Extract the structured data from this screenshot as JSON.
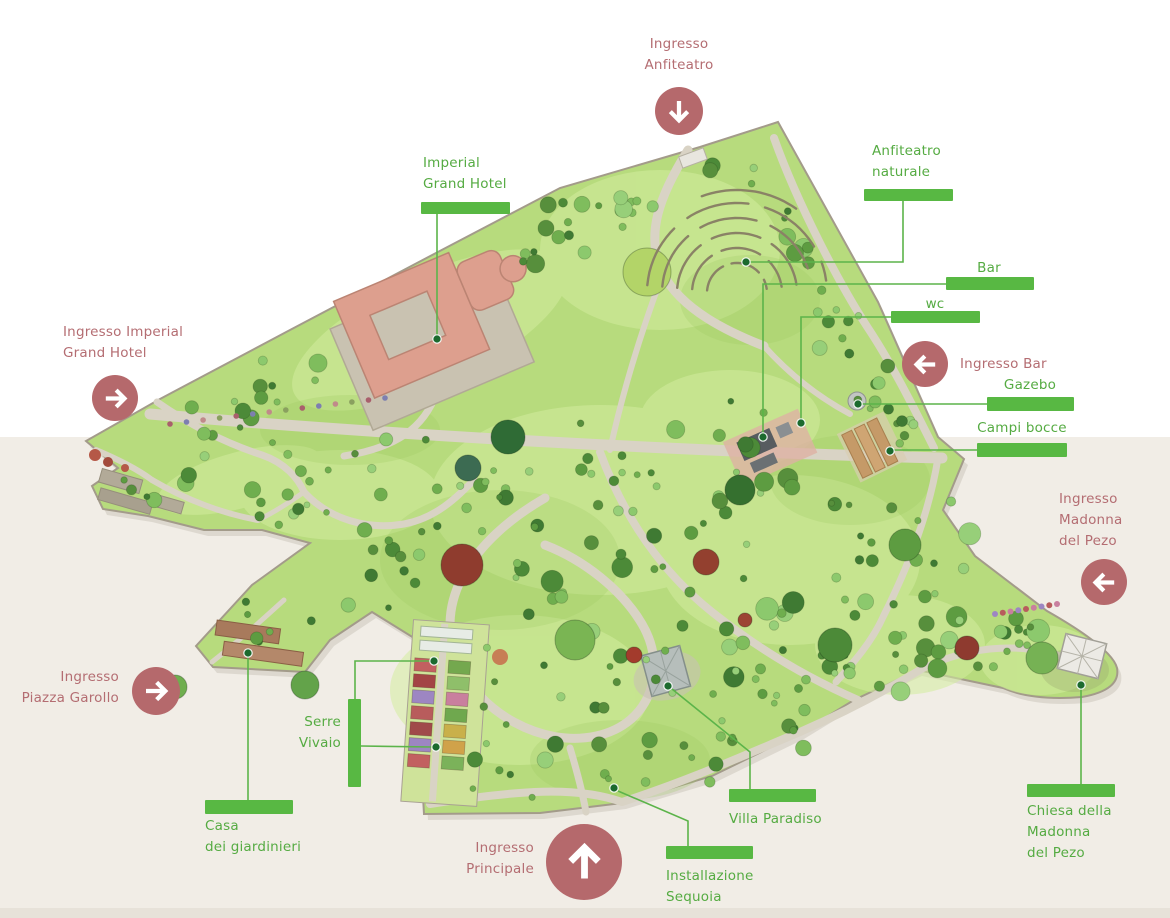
{
  "background": {
    "top_color": "#ffffff",
    "bottom_color": "#f1ede6",
    "bottom_strip_color": "#e7e2d9",
    "band_y": 437,
    "strip_y": 908
  },
  "palette": {
    "label_green": "#55ab42",
    "bar_green": "#58b843",
    "line_green": "#5cb44a",
    "dot_green": "#1c6a2e",
    "entrance_circle_red": "#b5696c",
    "entrance_text_red": "#b46d72",
    "arrow_white": "#ffffff",
    "lawn_green": "#b7db7d",
    "path_grey": "#d9d3c5",
    "hotel_roof_salmon": "#dd9f8e"
  },
  "poi_labels": [
    {
      "id": "imperial-grand-hotel",
      "lines": [
        "Imperial",
        "Grand Hotel"
      ],
      "text": {
        "left": 423,
        "top": 153,
        "width": 120,
        "align": "left"
      },
      "bar": {
        "x": 421,
        "y": 202,
        "w": 89,
        "h": 12
      },
      "connectors": [
        {
          "points": [
            [
              437,
              214
            ],
            [
              437,
              336
            ]
          ],
          "dot": [
            437,
            339
          ]
        }
      ]
    },
    {
      "id": "anfiteatro-naturale",
      "lines": [
        "Anfiteatro",
        "naturale"
      ],
      "text": {
        "left": 872,
        "top": 141,
        "width": 120,
        "align": "left"
      },
      "bar": {
        "x": 864,
        "y": 189,
        "w": 89,
        "h": 12
      },
      "connectors": [
        {
          "points": [
            [
              903,
              201
            ],
            [
              903,
              262
            ],
            [
              750,
              262
            ]
          ],
          "dot": [
            746,
            262
          ]
        }
      ]
    },
    {
      "id": "bar",
      "lines": [
        "Bar"
      ],
      "text": {
        "left": 939,
        "top": 258,
        "width": 100,
        "align": "center"
      },
      "bar": {
        "x": 946,
        "y": 277,
        "w": 88,
        "h": 13
      },
      "connectors": [
        {
          "points": [
            [
              946,
              284
            ],
            [
              763,
              284
            ],
            [
              763,
              433
            ]
          ],
          "dot": [
            763,
            437
          ]
        }
      ]
    },
    {
      "id": "wc",
      "lines": [
        "wc"
      ],
      "text": {
        "left": 885,
        "top": 294,
        "width": 100,
        "align": "center"
      },
      "bar": {
        "x": 891,
        "y": 311,
        "w": 89,
        "h": 12
      },
      "connectors": [
        {
          "points": [
            [
              891,
              317
            ],
            [
              801,
              317
            ],
            [
              801,
              419
            ]
          ],
          "dot": [
            801,
            423
          ]
        }
      ]
    },
    {
      "id": "gazebo",
      "lines": [
        "Gazebo"
      ],
      "text": {
        "left": 980,
        "top": 375,
        "width": 100,
        "align": "center"
      },
      "bar": {
        "x": 987,
        "y": 397,
        "w": 87,
        "h": 14
      },
      "connectors": [
        {
          "points": [
            [
              987,
              404
            ],
            [
              862,
              404
            ]
          ],
          "dot": [
            858,
            404
          ]
        }
      ]
    },
    {
      "id": "campi-bocce",
      "lines": [
        "Campi bocce"
      ],
      "text": {
        "left": 972,
        "top": 418,
        "width": 100,
        "align": "center"
      },
      "bar": {
        "x": 977,
        "y": 443,
        "w": 90,
        "h": 14
      },
      "connectors": [
        {
          "points": [
            [
              977,
              450
            ],
            [
              894,
              450
            ]
          ],
          "dot": [
            890,
            451
          ]
        }
      ]
    },
    {
      "id": "serre-vivaio",
      "lines": [
        "Serre",
        "Vivaio"
      ],
      "text": {
        "left": 241,
        "top": 712,
        "width": 100,
        "align": "right"
      },
      "bar": {
        "x": 348,
        "y": 699,
        "w": 13,
        "h": 88
      },
      "connectors": [
        {
          "points": [
            [
              355,
              699
            ],
            [
              355,
              661
            ],
            [
              430,
              661
            ]
          ],
          "dot": [
            434,
            661
          ]
        },
        {
          "points": [
            [
              361,
              746
            ],
            [
              432,
              747
            ]
          ],
          "dot": [
            436,
            747
          ]
        }
      ]
    },
    {
      "id": "casa-dei-giardinieri",
      "lines": [
        "Casa",
        "dei giardinieri"
      ],
      "text": {
        "left": 205,
        "top": 816,
        "width": 140,
        "align": "left"
      },
      "bar": {
        "x": 205,
        "y": 800,
        "w": 88,
        "h": 14
      },
      "connectors": [
        {
          "points": [
            [
              248,
              800
            ],
            [
              248,
              657
            ]
          ],
          "dot": [
            248,
            653
          ]
        }
      ]
    },
    {
      "id": "villa-paradiso",
      "lines": [
        "Villa Paradiso"
      ],
      "text": {
        "left": 729,
        "top": 809,
        "width": 120,
        "align": "left"
      },
      "bar": {
        "x": 729,
        "y": 789,
        "w": 87,
        "h": 13
      },
      "connectors": [
        {
          "points": [
            [
              750,
              789
            ],
            [
              750,
              752
            ],
            [
              672,
              689
            ]
          ],
          "dot": [
            668,
            686
          ]
        }
      ]
    },
    {
      "id": "installazione-sequoia",
      "lines": [
        "Installazione",
        "Sequoia"
      ],
      "text": {
        "left": 666,
        "top": 866,
        "width": 130,
        "align": "left"
      },
      "bar": {
        "x": 666,
        "y": 846,
        "w": 87,
        "h": 13
      },
      "connectors": [
        {
          "points": [
            [
              688,
              846
            ],
            [
              688,
              821
            ],
            [
              618,
              791
            ]
          ],
          "dot": [
            614,
            788
          ]
        }
      ]
    },
    {
      "id": "chiesa-madonna-del-pezo",
      "lines": [
        "Chiesa della",
        "Madonna",
        "del Pezo"
      ],
      "text": {
        "left": 1027,
        "top": 801,
        "width": 120,
        "align": "left"
      },
      "bar": {
        "x": 1027,
        "y": 784,
        "w": 88,
        "h": 13
      },
      "connectors": [
        {
          "points": [
            [
              1081,
              784
            ],
            [
              1081,
              689
            ]
          ],
          "dot": [
            1081,
            685
          ]
        }
      ]
    }
  ],
  "entrances": [
    {
      "id": "anfiteatro",
      "lines": [
        "Ingresso",
        "Anfiteatro"
      ],
      "arrow": "down",
      "circle": {
        "cx": 679,
        "cy": 111,
        "r": 24
      },
      "text": {
        "left": 599,
        "top": 34,
        "width": 160,
        "align": "center"
      }
    },
    {
      "id": "imperial-grand-hotel",
      "lines": [
        "Ingresso Imperial",
        "Grand Hotel"
      ],
      "arrow": "right",
      "circle": {
        "cx": 115,
        "cy": 398,
        "r": 23
      },
      "text": {
        "left": 63,
        "top": 322,
        "width": 170,
        "align": "left"
      }
    },
    {
      "id": "bar",
      "lines": [
        "Ingresso Bar"
      ],
      "arrow": "left",
      "circle": {
        "cx": 925,
        "cy": 364,
        "r": 23
      },
      "text": {
        "left": 960,
        "top": 354,
        "width": 130,
        "align": "left"
      }
    },
    {
      "id": "madonna-del-pezo",
      "lines": [
        "Ingresso",
        "Madonna",
        "del Pezo"
      ],
      "arrow": "left",
      "circle": {
        "cx": 1104,
        "cy": 582,
        "r": 23
      },
      "text": {
        "left": 1059,
        "top": 489,
        "width": 110,
        "align": "left"
      }
    },
    {
      "id": "piazza-garollo",
      "lines": [
        "Ingresso",
        "Piazza Garollo"
      ],
      "arrow": "right",
      "circle": {
        "cx": 156,
        "cy": 691,
        "r": 24
      },
      "text": {
        "left": 0,
        "top": 667,
        "width": 119,
        "align": "right"
      }
    },
    {
      "id": "principale",
      "lines": [
        "Ingresso",
        "Principale"
      ],
      "arrow": "up",
      "circle": {
        "cx": 584,
        "cy": 862,
        "r": 38
      },
      "text": {
        "left": 386,
        "top": 838,
        "width": 148,
        "align": "right"
      }
    }
  ]
}
